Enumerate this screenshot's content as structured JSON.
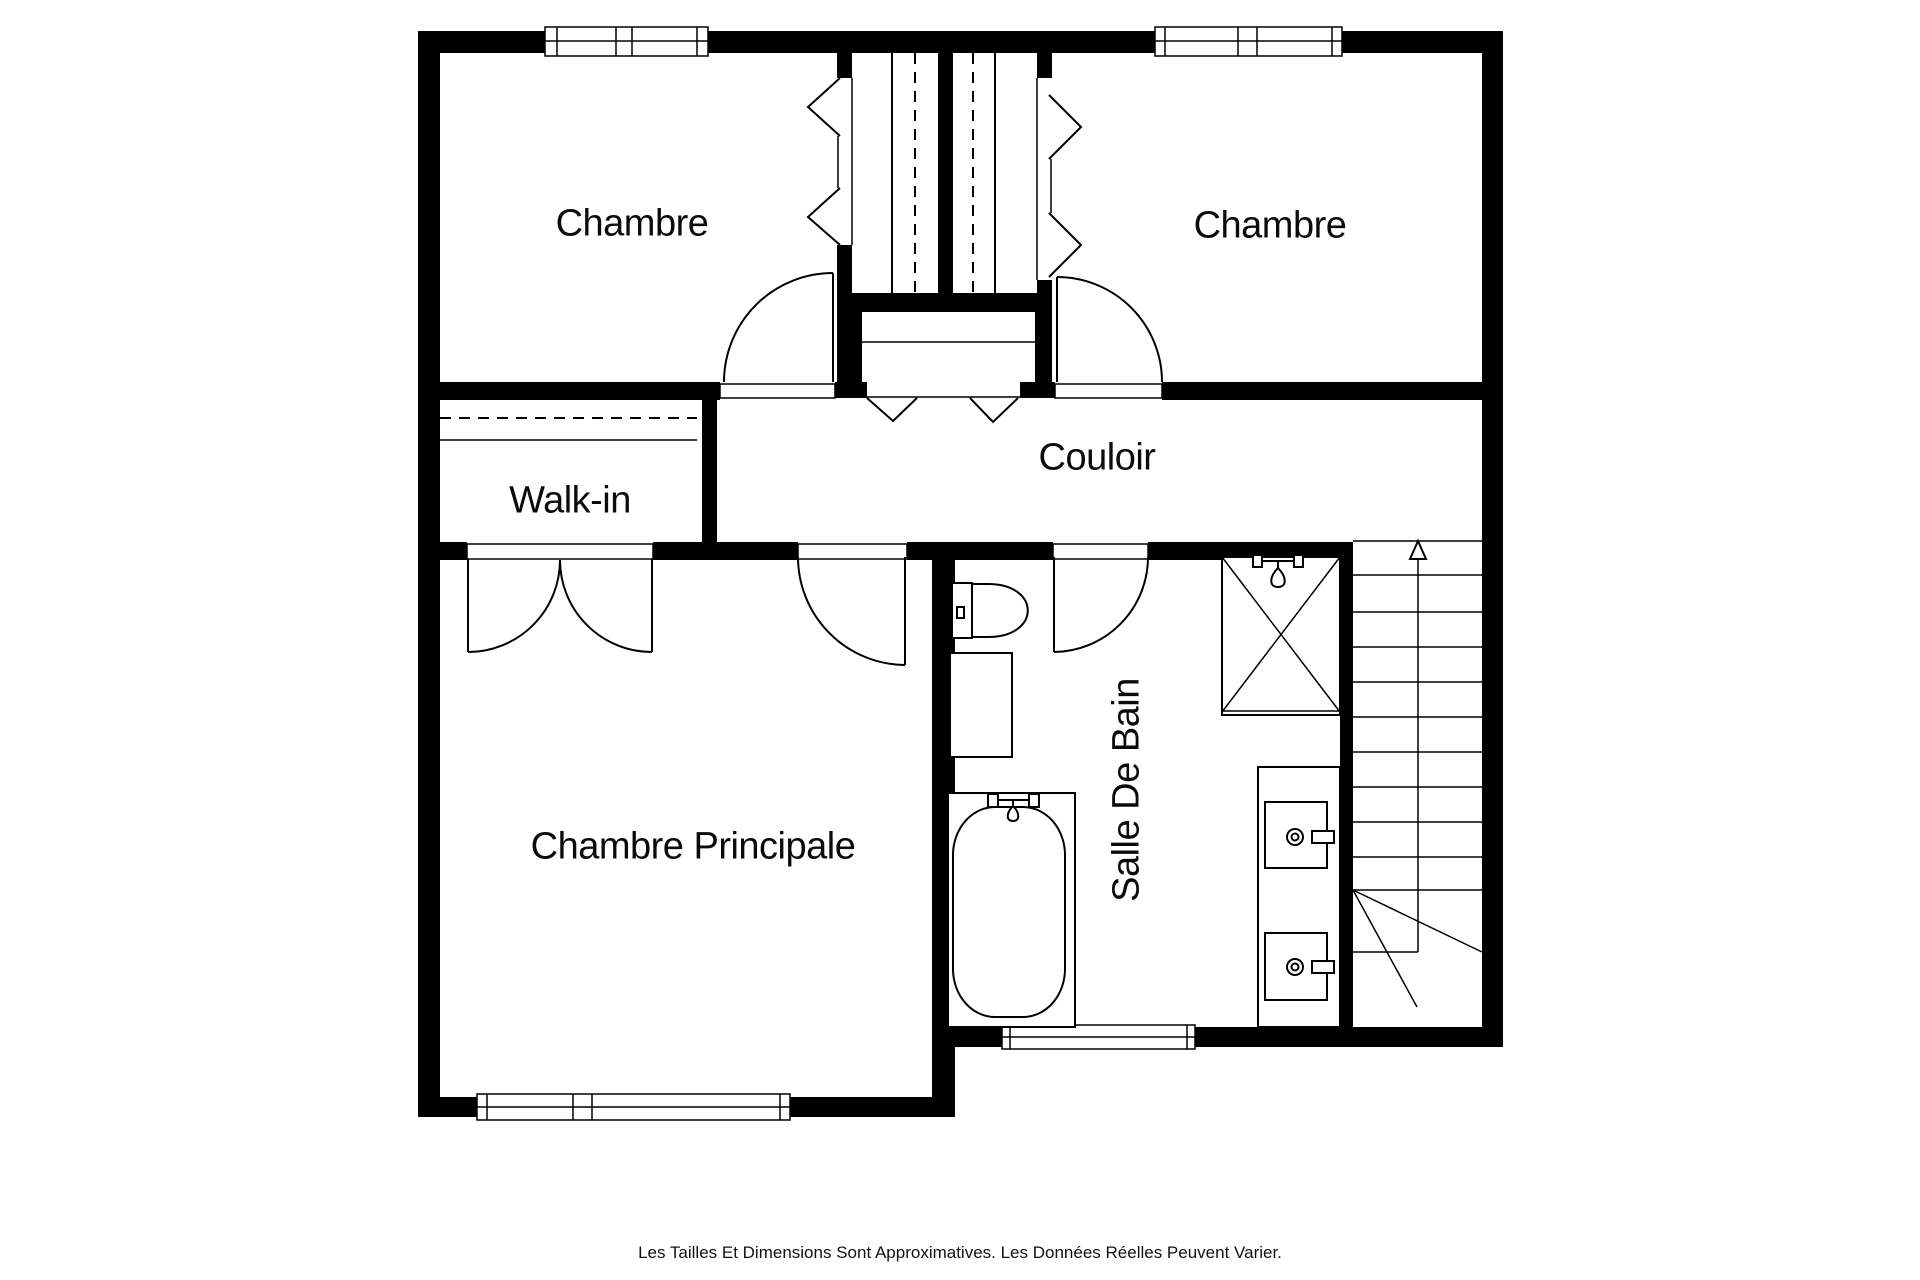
{
  "plan": {
    "rooms": {
      "bedroom_left": "Chambre",
      "bedroom_right": "Chambre",
      "hallway": "Couloir",
      "walk_in": "Walk-in",
      "master_bedroom": "Chambre Principale",
      "bathroom": "Salle De Bain"
    },
    "disclaimer": "Les Tailles Et Dimensions Sont Approximatives. Les Données Réelles Peuvent Varier.",
    "colors": {
      "walls": "#000000",
      "background": "#ffffff",
      "lines": "#000000",
      "text": "#0b0b0b"
    },
    "fixtures": [
      "toilet",
      "washbasin-cabinet",
      "bathtub",
      "shower-stall",
      "double-sink-vanity",
      "staircase",
      "wardrobe-closets",
      "linen-closet",
      "walk-in-shelf"
    ]
  }
}
